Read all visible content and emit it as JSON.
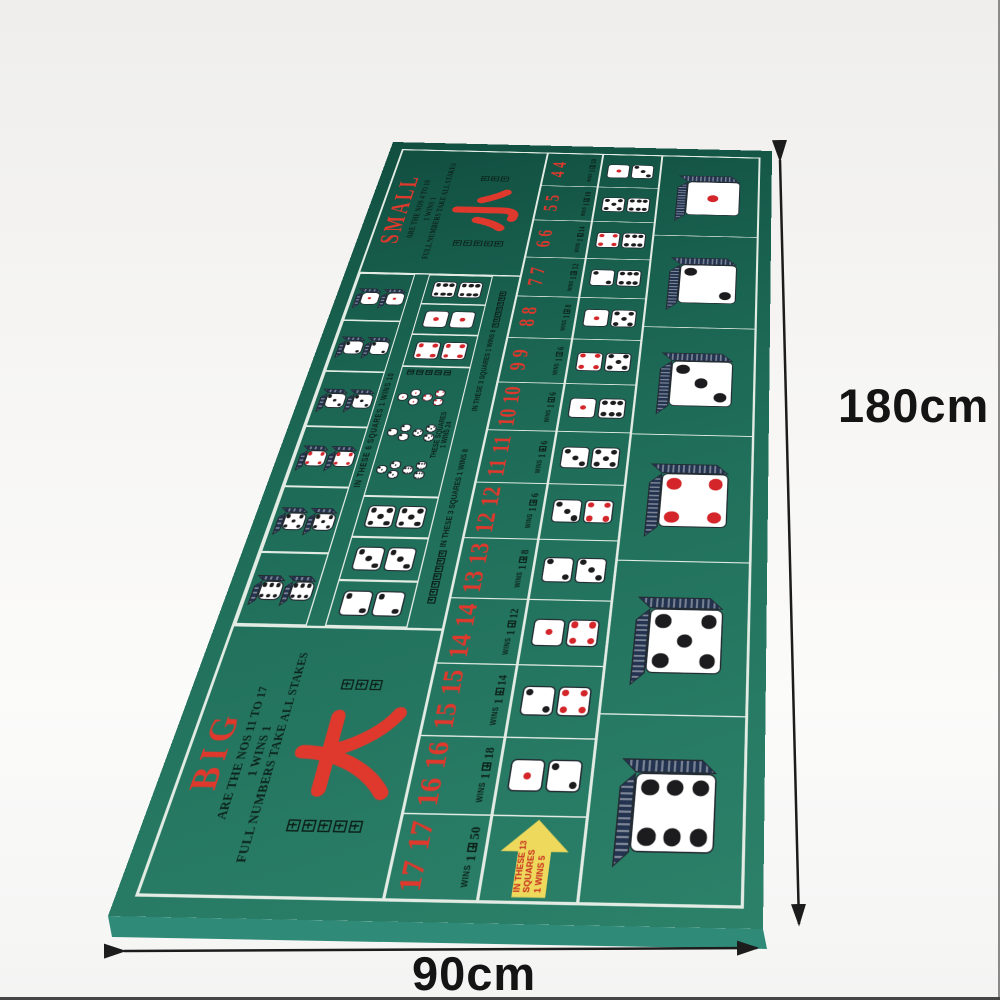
{
  "dimensions": {
    "height_label": "180cm",
    "width_label": "90cm"
  },
  "colors": {
    "mat_green_near": "#2c8169",
    "mat_green_mid": "#1e6c58",
    "mat_green_far": "#114e40",
    "grid_line": "#e3ece4",
    "print_red": "#df382c",
    "pip_red": "#d4262a",
    "pip_black": "#1c1c1e",
    "arrow_yellow": "#eed95c",
    "text_black": "#0c231b"
  },
  "big_box": {
    "title": "BIG",
    "line1": "ARE THE NOS 11 TO 17",
    "line2": "1 WINS 1",
    "line3": "FULL NUMBERS TAKE ALL STAKES",
    "hanzi_big": "大",
    "hanzi_left": "達全色統吃",
    "hanzi_right": "一中一"
  },
  "small_box": {
    "title": "SMALL",
    "line1": "ARE THE NOS 4 TO 10",
    "line2": "1 WINS 1",
    "line3": "FULL NUMBERS TAKE ALL STAKES",
    "hanzi_big": "小",
    "hanzi_left": "達全色統吃",
    "hanzi_right": "一中一"
  },
  "doubles_row": {
    "label_en": "IN THESE 6 SQUARES 1 WINS 10",
    "cells": [
      6,
      5,
      4,
      3,
      2,
      1
    ]
  },
  "pairs_row": {
    "cells_left": [
      2,
      3,
      5
    ],
    "cells_right": [
      4,
      1,
      6
    ],
    "label_cn": "以上三口一中八",
    "label_en": "IN THESE 3 SQUARES 1 WINS 8"
  },
  "any_triple_box": {
    "triples_top": [
      3,
      2,
      1
    ],
    "triples_bottom": [
      6,
      5,
      4
    ],
    "text_line1": "THESE SQUARES",
    "text_line2": "1 WINS 24",
    "text_cn": "一中二十四"
  },
  "numbers_row": {
    "wins_word": "WINS",
    "cells": [
      {
        "value": "17",
        "odds": "1中50",
        "odds_prefix": "1",
        "odds_suffix": "50"
      },
      {
        "value": "16",
        "odds": "1中18",
        "odds_prefix": "1",
        "odds_suffix": "18"
      },
      {
        "value": "15",
        "odds": "1中14",
        "odds_prefix": "1",
        "odds_suffix": "14"
      },
      {
        "value": "14",
        "odds": "1中12",
        "odds_prefix": "1",
        "odds_suffix": "12"
      },
      {
        "value": "13",
        "odds": "1中8",
        "odds_prefix": "1",
        "odds_suffix": "8"
      },
      {
        "value": "12",
        "odds": "1中6",
        "odds_prefix": "1",
        "odds_suffix": "6"
      },
      {
        "value": "11",
        "odds": "1中6",
        "odds_prefix": "1",
        "odds_suffix": "6"
      },
      {
        "value": "10",
        "odds": "1中6",
        "odds_prefix": "1",
        "odds_suffix": "6"
      },
      {
        "value": "9",
        "odds": "1中6",
        "odds_prefix": "1",
        "odds_suffix": "6"
      },
      {
        "value": "8",
        "odds": "1中8",
        "odds_prefix": "1",
        "odds_suffix": "8"
      },
      {
        "value": "7",
        "odds": "1中12",
        "odds_prefix": "1",
        "odds_suffix": "12"
      },
      {
        "value": "6",
        "odds": "1中14",
        "odds_prefix": "1",
        "odds_suffix": "14"
      },
      {
        "value": "5",
        "odds": "1中18",
        "odds_prefix": "1",
        "odds_suffix": "18"
      },
      {
        "value": "4",
        "odds": "1中50",
        "odds_prefix": "1",
        "odds_suffix": "50"
      }
    ]
  },
  "combos_row": {
    "arrow_lines": [
      "IN THESE 13",
      "SQUARES",
      "1 WINS 5"
    ],
    "cells": [
      {
        "type": "arrow"
      },
      {
        "type": "dice",
        "dice": [
          1,
          2
        ]
      },
      {
        "type": "dice",
        "dice": [
          2,
          4
        ]
      },
      {
        "type": "dice",
        "dice": [
          1,
          4
        ]
      },
      {
        "type": "dice",
        "dice": [
          2,
          3
        ]
      },
      {
        "type": "dice",
        "dice": [
          3,
          4
        ]
      },
      {
        "type": "dice",
        "dice": [
          3,
          5
        ]
      },
      {
        "type": "dice",
        "dice": [
          1,
          6
        ]
      },
      {
        "type": "dice",
        "dice": [
          4,
          5
        ]
      },
      {
        "type": "dice",
        "dice": [
          1,
          5
        ]
      },
      {
        "type": "dice",
        "dice": [
          2,
          6
        ]
      },
      {
        "type": "dice",
        "dice": [
          4,
          6
        ]
      },
      {
        "type": "dice",
        "dice": [
          5,
          6
        ]
      },
      {
        "type": "dice",
        "dice": [
          1,
          3
        ]
      }
    ]
  },
  "single_dice_row": {
    "cells": [
      6,
      5,
      4,
      3,
      2,
      1
    ]
  },
  "red_pip_faces": [
    1,
    4
  ]
}
